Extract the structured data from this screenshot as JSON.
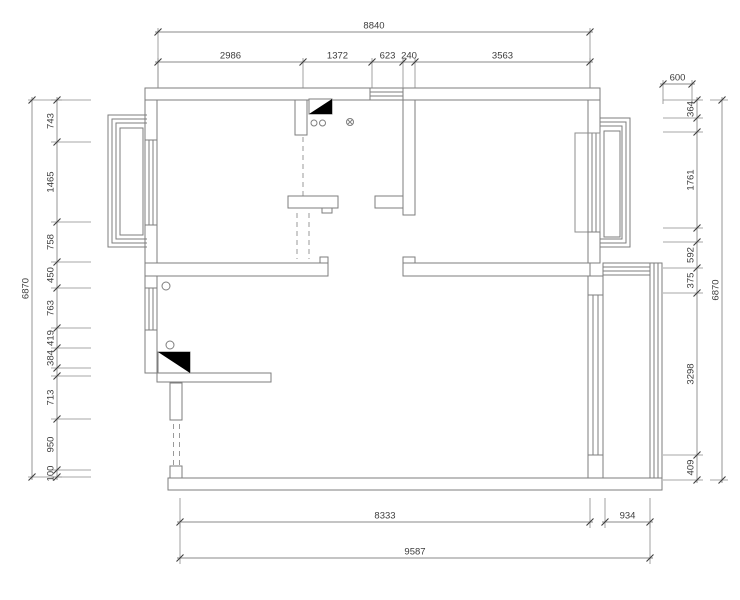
{
  "page": {
    "background": "#ffffff"
  },
  "drawing": {
    "kind": "architectural-floor-plan",
    "units": "mm",
    "colors": {
      "wall_line": "#7e7e7e",
      "frame_line": "#8d8d8d",
      "dim_line": "#8a8a8a",
      "tick": "#3c3c3c",
      "dim_text": "#3c3c3c",
      "fill": "#ffffff",
      "flue_fill": "#000000",
      "dashed": "#9a9a9a"
    },
    "overall": {
      "width_top": "8840",
      "width_bottom": "9587",
      "height_left": "6870",
      "height_right": "6870",
      "bay_overhang_right": "600"
    },
    "dim_chains": [
      {
        "id": "top-overall",
        "orientation": "h",
        "line": 32,
        "ticks": [
          158,
          590
        ],
        "labels": [
          "8840"
        ],
        "ext": [
          -4,
          56
        ]
      },
      {
        "id": "top-rooms",
        "orientation": "h",
        "line": 62,
        "ticks": [
          158,
          303,
          372,
          403,
          415,
          590
        ],
        "labels": [
          "2986",
          "1372",
          "623",
          "240",
          "3563"
        ],
        "ext": [
          -4,
          26
        ]
      },
      {
        "id": "right-overhang",
        "orientation": "h",
        "line": 84,
        "ticks": [
          663,
          692
        ],
        "labels": [
          "600"
        ],
        "ext": [
          -4,
          20
        ]
      },
      {
        "id": "left-outer",
        "orientation": "v",
        "line": 32,
        "ticks": [
          100,
          477
        ],
        "labels": [
          "6870"
        ],
        "ext": [
          -4,
          30
        ]
      },
      {
        "id": "left-rooms",
        "orientation": "v",
        "line": 57,
        "ticks": [
          100,
          142,
          222,
          262,
          288,
          328,
          348,
          368,
          376,
          419,
          470,
          477
        ],
        "labels": [
          "743",
          "1465",
          "758",
          "450",
          "763",
          "419",
          "384",
          "",
          "713",
          "950",
          "100"
        ],
        "ext": [
          -6,
          34
        ]
      },
      {
        "id": "right-rooms",
        "orientation": "v",
        "line": 697,
        "ticks": [
          100,
          118,
          132,
          228,
          242,
          268,
          293,
          455,
          480
        ],
        "labels": [
          "364",
          "",
          "1761",
          "",
          "592",
          "375",
          "3298",
          "409"
        ],
        "ext": [
          -34,
          6
        ]
      },
      {
        "id": "right-outer",
        "orientation": "v",
        "line": 722,
        "ticks": [
          100,
          480
        ],
        "labels": [
          "6870"
        ],
        "ext": [
          -12,
          6
        ]
      },
      {
        "id": "bottom-rooms",
        "orientation": "h",
        "line": 522,
        "ticks": [
          180,
          590
        ],
        "labels": [
          "8333"
        ],
        "ext": [
          -24,
          6
        ]
      },
      {
        "id": "bottom-balcony",
        "orientation": "h",
        "line": 522,
        "ticks": [
          605,
          650
        ],
        "labels": [
          "934"
        ],
        "ext": [
          -24,
          6
        ]
      },
      {
        "id": "bottom-overall",
        "orientation": "h",
        "line": 558,
        "ticks": [
          180,
          650
        ],
        "labels": [
          "9587"
        ],
        "ext": [
          -36,
          6
        ]
      }
    ],
    "symbols": [
      {
        "name": "flue-shaft-kitchen"
      },
      {
        "name": "flue-shaft-living"
      },
      {
        "name": "hob-burner-circles"
      },
      {
        "name": "floor-drain"
      },
      {
        "name": "bay-window-left"
      },
      {
        "name": "bay-window-right"
      },
      {
        "name": "balcony-window"
      },
      {
        "name": "door-opening-dashed"
      }
    ]
  }
}
